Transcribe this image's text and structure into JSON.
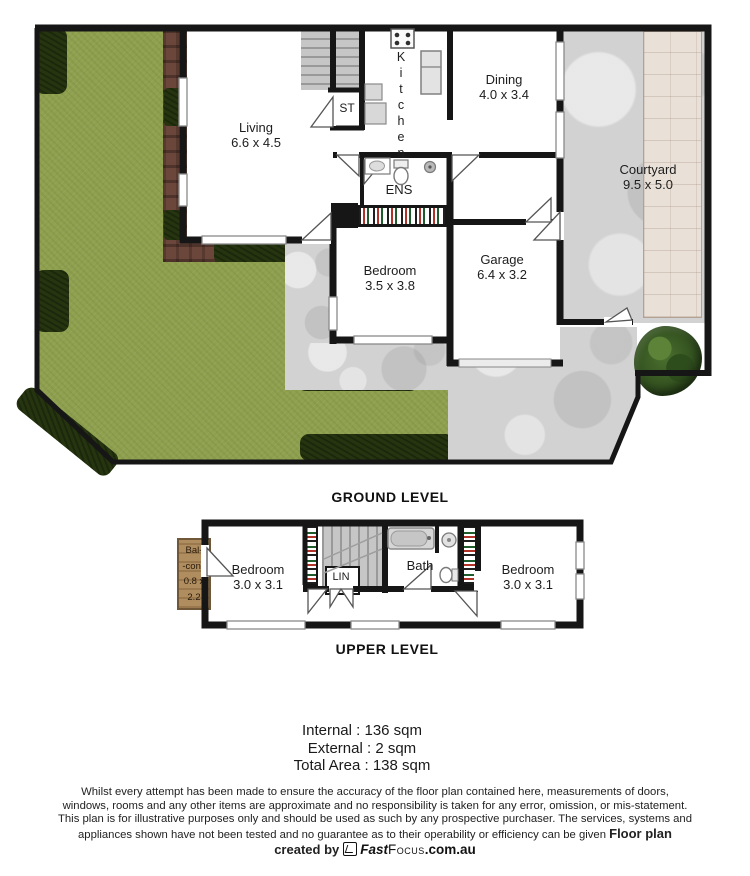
{
  "ground": {
    "caption": "GROUND LEVEL",
    "living_name": "Living",
    "living_dims": "6.6 x 4.5",
    "kitchen_name": "Kitchen",
    "dining_name": "Dining",
    "dining_dims": "4.0 x 3.4",
    "courtyard_name": "Courtyard",
    "courtyard_dims": "9.5 x 5.0",
    "ens_name": "ENS",
    "st_name": "ST",
    "bedroom_name": "Bedroom",
    "bedroom_dims": "3.5 x 3.8",
    "garage_name": "Garage",
    "garage_dims": "6.4 x 3.2"
  },
  "upper": {
    "caption": "UPPER LEVEL",
    "balcony_line1": "Bal-",
    "balcony_line2": "-cony",
    "balcony_line3": "0.8 x",
    "balcony_line4": "2.2",
    "bedroom1_name": "Bedroom",
    "bedroom1_dims": "3.0 x 3.1",
    "lin_name": "LIN",
    "bath_name": "Bath",
    "bedroom2_name": "Bedroom",
    "bedroom2_dims": "3.0 x 3.1"
  },
  "areas": {
    "internal": "Internal : 136 sqm",
    "external": "External : 2 sqm",
    "total": "Total Area : 138 sqm"
  },
  "disclaimer": "Whilst every attempt has been made to ensure the accuracy of the floor plan contained here, measurements of doors, windows, rooms and any other items are approximate and no responsibility is taken for any error, omission, or mis-statement. This plan is for illustrative purposes only and should be used as such by any prospective purchaser. The services, systems and appliances shown have not been tested and no guarantee as to their operability or efficiency can be given",
  "credit": {
    "prefix": "Floor plan created by",
    "brand_fast": "Fast",
    "brand_focus": "Focus",
    "brand_domain": ".com.au"
  },
  "colors": {
    "lawn": "#8fa04f",
    "hedge": "#263510",
    "brick": "#6b463a",
    "concrete": "#d2d2d2",
    "paving": "#e9e1d8",
    "wall": "#161616",
    "balcony": "#b08d5f",
    "tree": "#3c5f26"
  }
}
